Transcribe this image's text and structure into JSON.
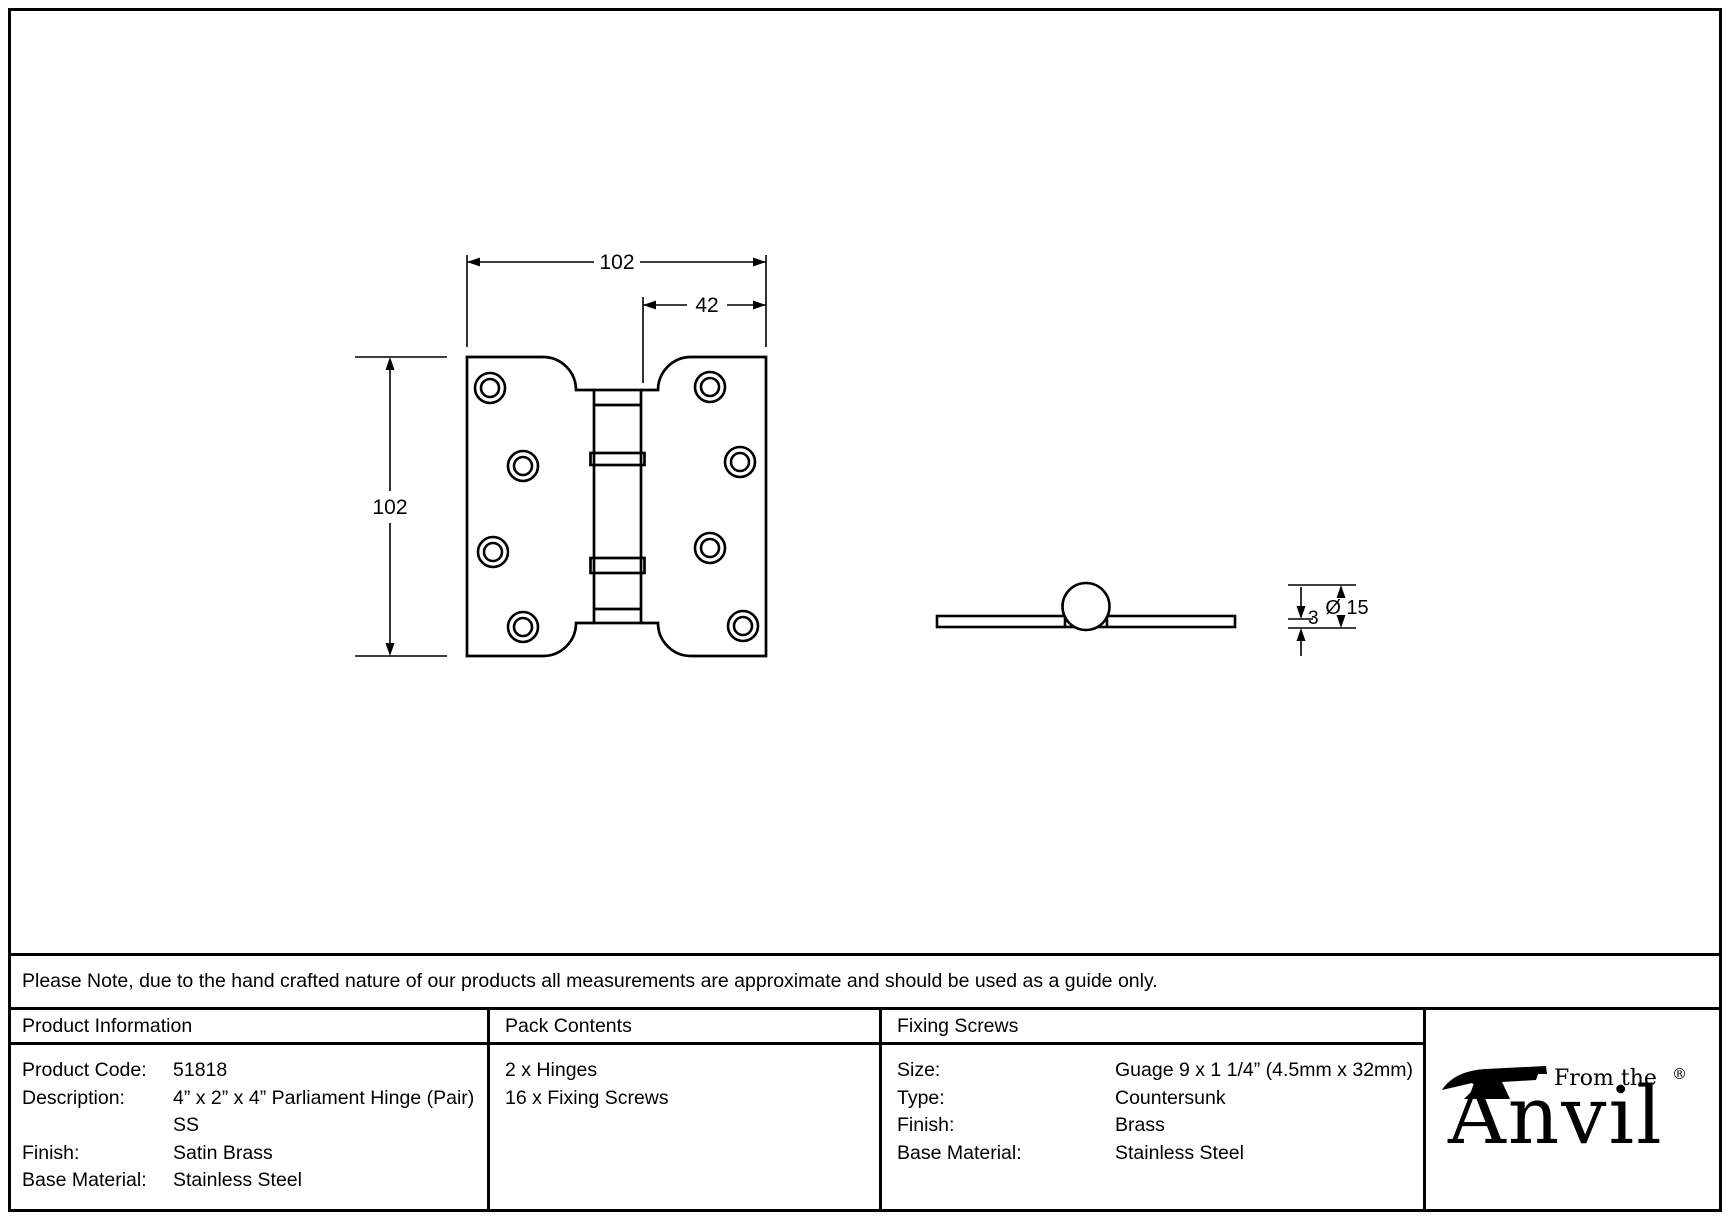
{
  "drawing": {
    "front_view": {
      "width_label": "102",
      "inset_label": "42",
      "height_label": "102"
    },
    "side_view": {
      "thickness_label": "3",
      "diameter_label": "Ø 15"
    }
  },
  "note": "Please Note, due to the hand crafted nature of our products all measurements are approximate and should be used as a guide only.",
  "table": {
    "product_information": {
      "header": "Product Information",
      "rows": [
        {
          "label": "Product Code:",
          "value": "51818"
        },
        {
          "label": "Description:",
          "value": "4” x 2” x 4” Parliament Hinge (Pair) SS"
        },
        {
          "label": "Finish:",
          "value": "Satin Brass"
        },
        {
          "label": "Base Material:",
          "value": "Stainless Steel"
        }
      ]
    },
    "pack_contents": {
      "header": "Pack Contents",
      "items": [
        "2 x Hinges",
        "16 x Fixing Screws"
      ]
    },
    "fixing_screws": {
      "header": "Fixing Screws",
      "rows": [
        {
          "label": "Size:",
          "value": "Guage 9 x 1 1/4” (4.5mm x 32mm)"
        },
        {
          "label": "Type:",
          "value": "Countersunk"
        },
        {
          "label": "Finish:",
          "value": "Brass"
        },
        {
          "label": "Base Material:",
          "value": "Stainless Steel"
        }
      ]
    }
  },
  "logo": {
    "tagline": "From the",
    "brand": "Anvil",
    "registered": "®"
  }
}
